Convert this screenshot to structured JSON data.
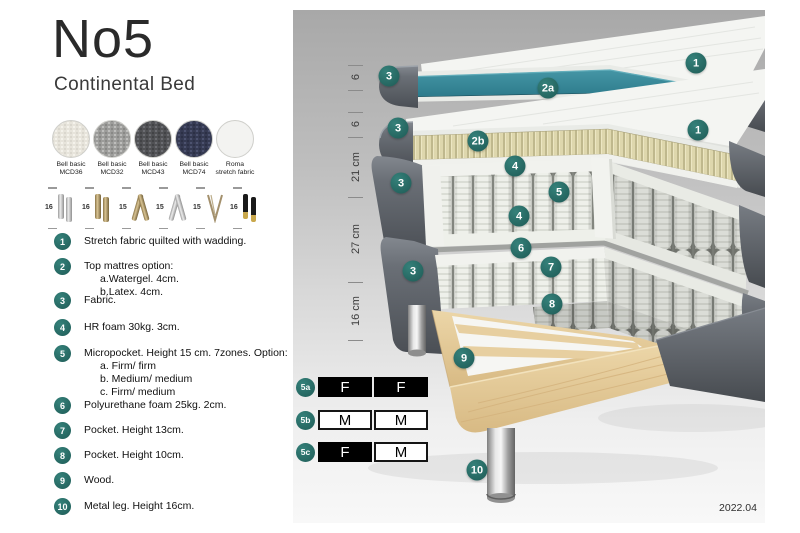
{
  "title": {
    "main": "No5",
    "subtitle": "Continental Bed"
  },
  "fabric_swatches": [
    {
      "line1": "Bell basic",
      "line2": "MCD36",
      "color": "#e7e4db"
    },
    {
      "line1": "Bell basic",
      "line2": "MCD32",
      "color": "#9c9c9a"
    },
    {
      "line1": "Bell basic",
      "line2": "MCD43",
      "color": "#505154"
    },
    {
      "line1": "Bell basic",
      "line2": "MCD74",
      "color": "#353a52"
    },
    {
      "line1": "Roma",
      "line2": "stretch fabric",
      "color": "#f3f3f1"
    }
  ],
  "leg_options": [
    {
      "height": "16",
      "name": "cylinder-silver"
    },
    {
      "height": "16",
      "name": "cylinder-brass"
    },
    {
      "height": "15",
      "name": "twist-gold"
    },
    {
      "height": "15",
      "name": "twist-silver"
    },
    {
      "height": "15",
      "name": "hairpin"
    },
    {
      "height": "16",
      "name": "cylinder-black-gold"
    }
  ],
  "spec_list": [
    {
      "num": "1",
      "text": "Stretch fabric quilted with wadding."
    },
    {
      "num": "2",
      "text": "Top mattres option:",
      "sub": [
        "a.Watergel. 4cm.",
        "b.Latex. 4cm."
      ]
    },
    {
      "num": "3",
      "text": "Fabric."
    },
    {
      "num": "4",
      "text": "HR foam 30kg. 3cm."
    },
    {
      "num": "5",
      "text": "Micropocket. Height 15 cm. 7zones. Option:",
      "sub": [
        "a. Firm/ firm",
        "b. Medium/ medium",
        "c. Firm/ medium"
      ]
    },
    {
      "num": "6",
      "text": "Polyurethane foam 25kg. 2cm."
    },
    {
      "num": "7",
      "text": "Pocket. Height 13cm."
    },
    {
      "num": "8",
      "text": "Pocket. Height 10cm."
    },
    {
      "num": "9",
      "text": "Wood."
    },
    {
      "num": "10",
      "text": "Metal leg. Height 16cm."
    }
  ],
  "diagram": {
    "measurements": [
      "6",
      "6",
      "21 cm",
      "27 cm",
      "16 cm"
    ],
    "callouts": [
      "1",
      "1",
      "2a",
      "2b",
      "3",
      "3",
      "3",
      "3",
      "4",
      "4",
      "5",
      "6",
      "7",
      "8",
      "9",
      "10"
    ],
    "firmness_rows": [
      {
        "label": "5a",
        "cell1": "F",
        "cell2": "F"
      },
      {
        "label": "5b",
        "cell1": "M",
        "cell2": "M"
      },
      {
        "label": "5c",
        "cell1": "F",
        "cell2": "M"
      }
    ],
    "revision_date": "2022.04",
    "colors": {
      "callout_teal": "#266a64",
      "watergel_teal": "#2f7d8e",
      "latex_cream": "#ddd6ac",
      "wood": "#e8d3a5"
    }
  }
}
